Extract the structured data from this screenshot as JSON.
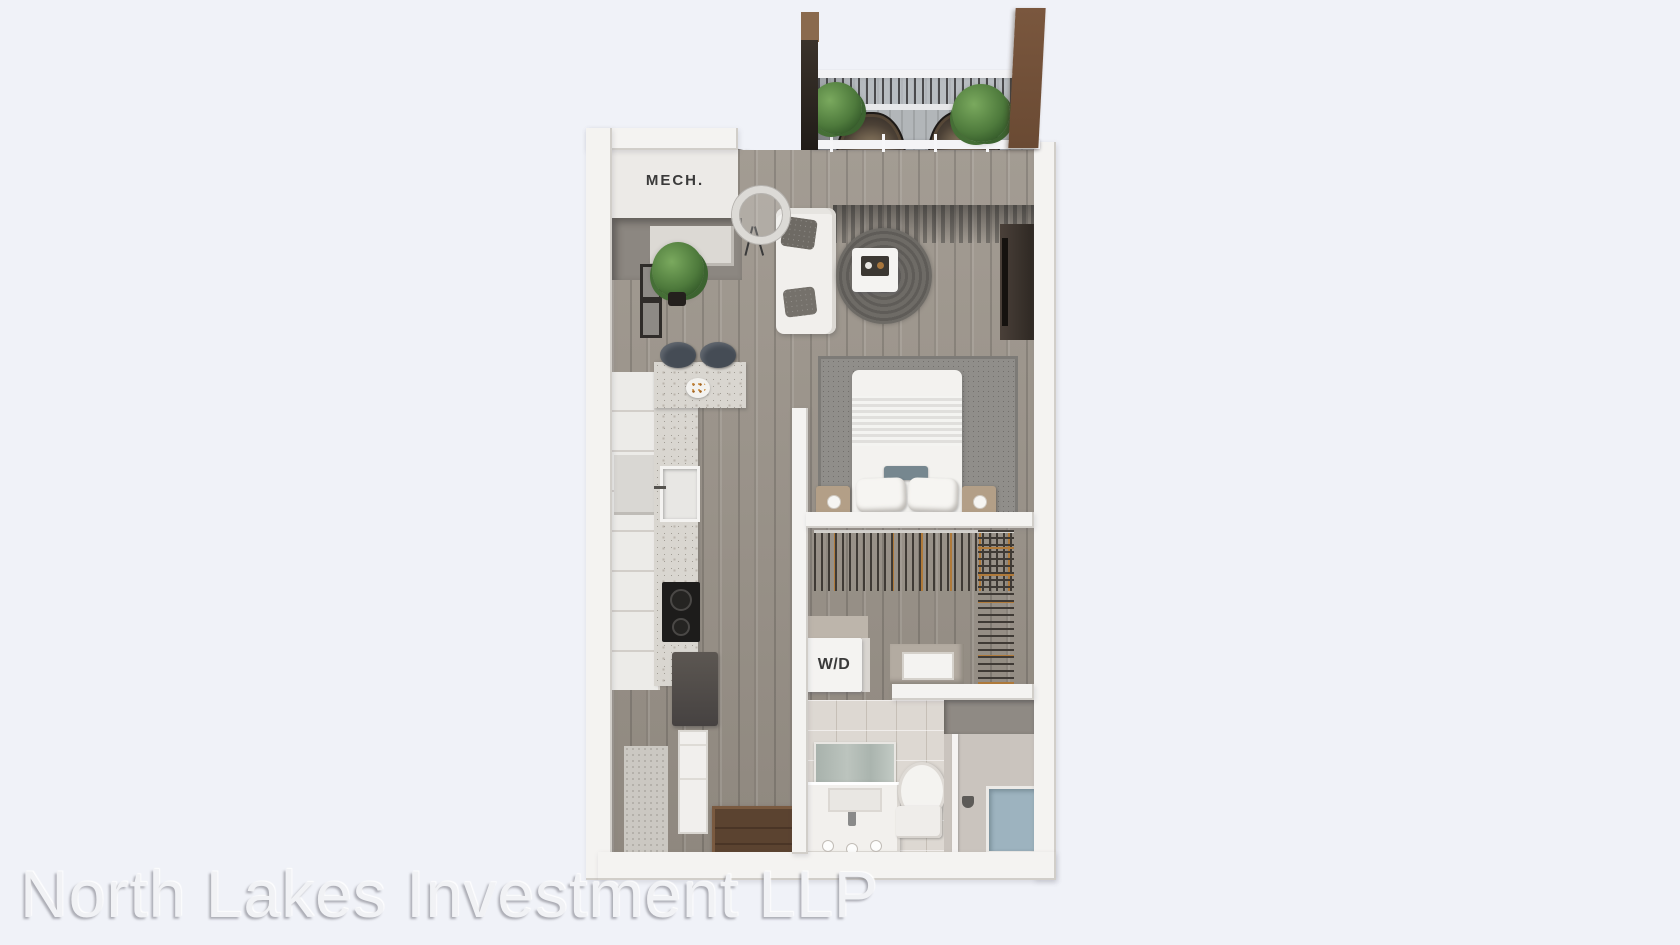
{
  "page": {
    "background_color": "#f0f2f8"
  },
  "floorplan": {
    "type": "3d-rendered-apartment-floor-plan",
    "labels": {
      "mech_room": "MECH.",
      "washer_dryer": "W/D"
    },
    "rooms": [
      "balcony",
      "mechanical-closet",
      "living-room",
      "kitchen",
      "bedroom",
      "walk-in-closet",
      "laundry-closet",
      "bathroom",
      "entry-hall"
    ],
    "colors": {
      "wall": "#f4f3f1",
      "wood_floor": "#a09a91",
      "balcony_floor": "#b2b6b9",
      "accent_wall_brown": "#6e4f38",
      "bed_blanket": "#8296a4",
      "plant_green": "#4e7a3c",
      "counter_speckle": "#d9d6d0"
    }
  },
  "watermark": {
    "text": "North Lakes Investment LLP",
    "color": "#f1f2f5"
  }
}
